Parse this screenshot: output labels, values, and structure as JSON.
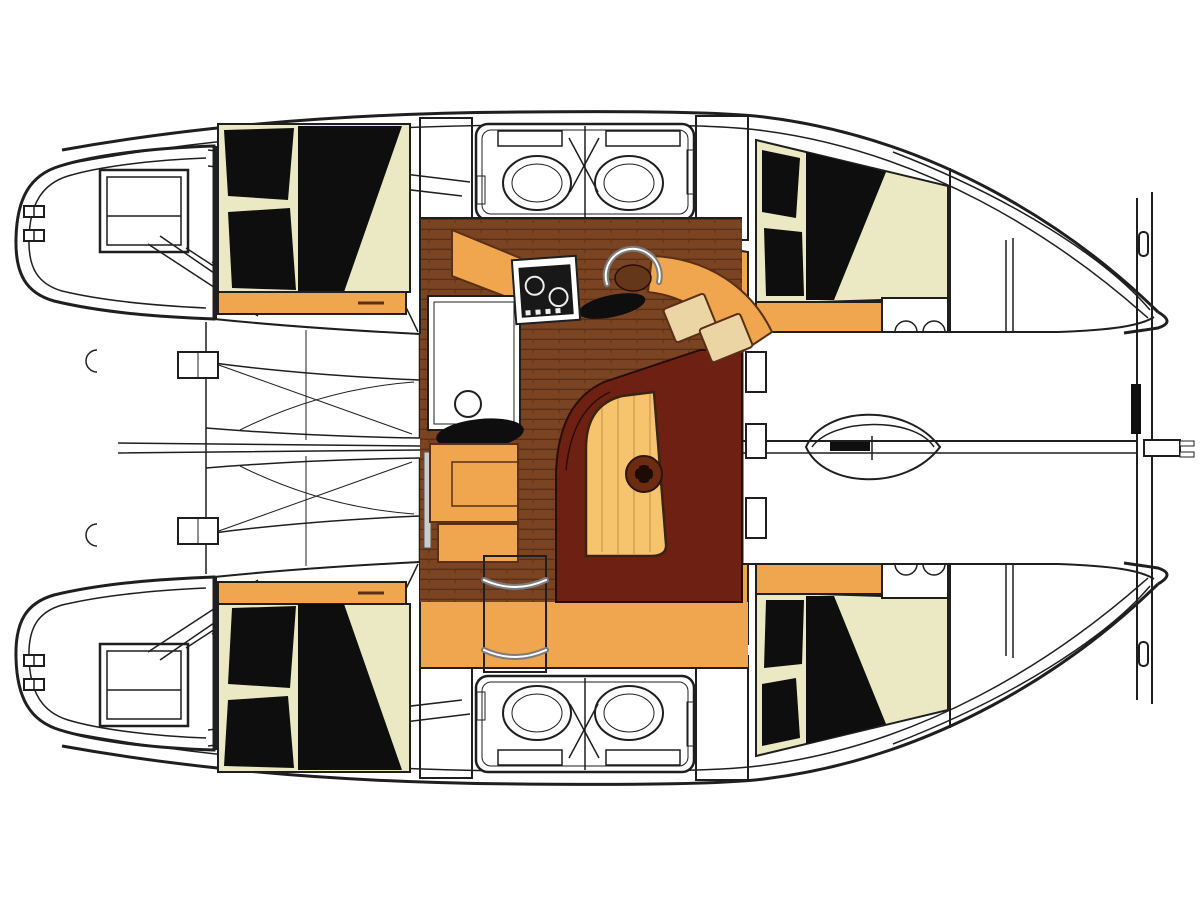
{
  "diagram": {
    "type": "boat-deck-plan",
    "subject": "catamaran-interior-layout-top-view",
    "orientation": "bow-right-stern-left"
  },
  "palette": {
    "paper": "#ffffff",
    "line": "#1f1f1f",
    "bed_cream": "#ebe9c3",
    "pillow_black": "#0e0e0e",
    "furniture_orange": "#f0a64e",
    "table_wood": "#f6c46d",
    "cushion_tan": "#ecd5a4",
    "floor_wood": "#7a4423",
    "floor_wood_line": "#5b2f15",
    "stair_wood": "#64371b",
    "settee_maroon": "#6e2113",
    "compass_brown": "#6b2c12",
    "appliance_black": "#181818",
    "chrome": "#7c7c7c"
  },
  "regions": {
    "layout": "catamaran deck plan",
    "port_transom": "port transom platform with steps and window",
    "starboard_transom": "starboard transom platform with steps and window",
    "aft_cockpit": "aft cockpit with bench seating",
    "port_hull": "port hull",
    "starboard_hull": "starboard hull",
    "port_aft_cabin": "port aft cabin double berth",
    "port_bathroom": "port bathroom with twin sinks",
    "port_forward_cabin": "port forward cabin double berth",
    "starboard_aft_cabin": "starboard aft cabin double berth",
    "starboard_bathroom": "starboard bathroom with twin sinks",
    "starboard_forward_cabin": "starboard forward cabin double berth",
    "salon": "salon with U-shaped settee",
    "salon_table": "salon table with compass rose",
    "galley": "galley with stove, sink and refrigerator",
    "nav_seat": "navigation seat and chart cushions",
    "companionway": "companionway steps to hull",
    "foredeck": "foredeck and trampoline area",
    "crossbeam": "forward crossbeam with anchor fitting",
    "bow_port": "port bow",
    "bow_starboard": "starboard bow"
  }
}
